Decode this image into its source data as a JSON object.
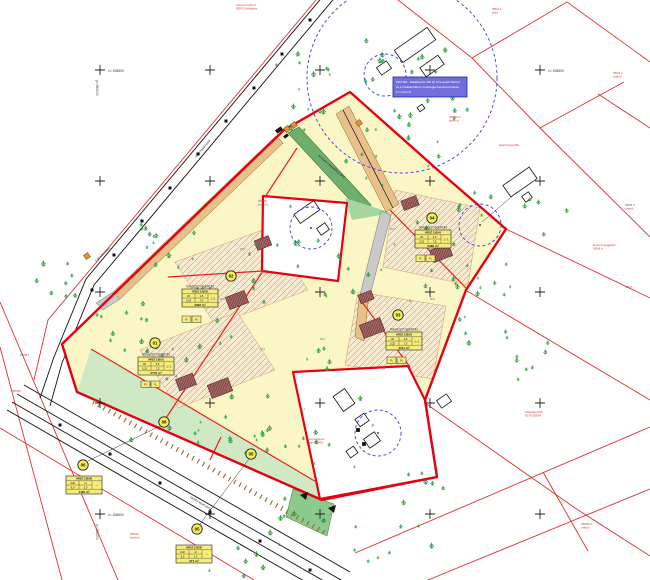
{
  "colors": {
    "parcel_red": "#e03030",
    "boundary_red": "#e60012",
    "site_yellow": "#fbf6c6",
    "zone_bg": "#f8e9cf",
    "zone_hatch": "#d06a35",
    "building_fill": "#8a4a4a",
    "green_strip": "#cfe9c4",
    "green_dark": "#8cc98c",
    "ditch_green": "#6fae6f",
    "drive_tan": "#e7c189",
    "drive_gray": "#c9c9c9",
    "note_blue": "#7070dd",
    "dash_blue": "#3b3be8",
    "tree_green": "#2f9e44",
    "table_yellow": "#f6ec7a"
  },
  "note_box": {
    "lines": [
      "PRV 661 - kialakítandó 160 fm vízvezeték hálózat",
      "és a csatlakozáshoz szükséges bekötővezetékek",
      "5 m² közmű"
    ]
  },
  "coord_labels": [
    {
      "x": 108,
      "y": 72,
      "text": "x= 458850",
      "vx": 96,
      "vy": 80,
      "vtext": "y= 562000"
    },
    {
      "x": 548,
      "y": 72,
      "text": "x= 458850",
      "vx": 0,
      "vy": 0,
      "vtext": ""
    },
    {
      "x": 108,
      "y": 516,
      "text": "x= 458650",
      "vx": 96,
      "vy": 524,
      "vtext": "y= 562000"
    }
  ],
  "grid": {
    "cols": [
      100,
      210,
      320,
      430,
      540
    ],
    "rows": [
      70,
      181,
      292,
      403,
      514
    ]
  },
  "plots": [
    {
      "id": "01",
      "circles": [
        [
          155,
          343
        ]
      ],
      "p": [
        141,
        381
      ],
      "p1": "P₁",
      "p2": "P₂",
      "table": {
        "x": 138,
        "y": 357,
        "title": "TERVEZETT BEÉPÍTÉS",
        "header": "HRSZ 1305/1",
        "r1a": "30",
        "r1b": "4,5",
        "r2a": "0,25",
        "r2b": "7,5",
        "ratio": "1 / 1",
        "area": "2775 m²"
      }
    },
    {
      "id": "02",
      "circles": [
        [
          231,
          276
        ]
      ],
      "p": [
        182,
        316
      ],
      "p1": "P₁",
      "p2": "P₂",
      "table": {
        "x": 182,
        "y": 289,
        "title": "TERVEZETT BEÉPÍTÉS",
        "header": "HRSZ 1305/2",
        "r1a": "30",
        "r1b": "4,5",
        "r2a": "0,25",
        "r2b": "7,5",
        "ratio": "1 / 1",
        "area": "2922 m²"
      }
    },
    {
      "id": "03",
      "circles": [
        [
          398,
          315
        ]
      ],
      "p": [
        387,
        357
      ],
      "p1": "P₁",
      "p2": "P₂",
      "table": {
        "x": 386,
        "y": 332,
        "title": "TERVEZETT BEÉPÍTÉS",
        "header": "HRSZ 1305/3",
        "r1a": "30",
        "r1b": "4,5",
        "r2a": "0,25",
        "r2b": "7,5",
        "ratio": "1 / 1",
        "area": "2011 m²"
      }
    },
    {
      "id": "04",
      "circles": [
        [
          432,
          218
        ]
      ],
      "p": [
        416,
        255
      ],
      "p1": "P₁",
      "p2": "P₂",
      "table": {
        "x": 415,
        "y": 230,
        "title": "TERVEZETT BEÉPÍTÉS",
        "header": "HRSZ 1305/4",
        "r1a": "30",
        "r1b": "4,5",
        "r2a": "0,25",
        "r2b": "7,5",
        "ratio": "1 / 1",
        "area": "2989 m²"
      }
    },
    {
      "id": "05",
      "circles": [
        [
          251,
          454
        ],
        [
          197,
          529
        ]
      ],
      "p": null,
      "p1": "",
      "p2": "",
      "table": {
        "x": 176,
        "y": 545,
        "title": "",
        "header": "HRSZ 1305/5",
        "r1a": "zöld",
        "r1b": "út",
        "r2a": "6,0",
        "r2b": "3,0",
        "ratio": "—",
        "area": "671 m²"
      }
    },
    {
      "id": "06",
      "circles": [
        [
          164,
          422
        ],
        [
          83,
          465
        ]
      ],
      "p": null,
      "p1": "",
      "p2": "",
      "table": {
        "x": 66,
        "y": 476,
        "title": "",
        "header": "HRSZ 1305/6",
        "r1a": "zöld",
        "r1b": "út",
        "r2a": "6,0",
        "r2b": "3,0",
        "ratio": "—",
        "area": "1420 m²"
      }
    }
  ],
  "red_labels": [
    {
      "x": 236,
      "y": 6,
      "lines": [
        "Tervezett 20 kV",
        "055/71 földkábel"
      ]
    },
    {
      "x": 492,
      "y": 10,
      "lines": [
        "055/2 b",
        "erdő"
      ]
    },
    {
      "x": 613,
      "y": 74,
      "lines": [
        "055/4 c",
        "szántó"
      ]
    },
    {
      "x": 449,
      "y": 118,
      "lines": [
        "055/60-2",
        "kivett út"
      ]
    },
    {
      "x": 499,
      "y": 146,
      "lines": [
        "kivett tanya 05a"
      ]
    },
    {
      "x": 625,
      "y": 206,
      "lines": [
        "055/5 b",
        "szántó"
      ]
    },
    {
      "x": 593,
      "y": 246,
      "lines": [
        "kivett anyaggödör",
        "055/6 b"
      ]
    },
    {
      "x": 625,
      "y": 288,
      "lines": [
        "055/7"
      ]
    },
    {
      "x": 258,
      "y": 202,
      "lines": [
        "055/59",
        "kivett út"
      ]
    },
    {
      "x": 525,
      "y": 413,
      "lines": [
        "külterület 05b",
        "6070 055/64"
      ]
    },
    {
      "x": 581,
      "y": 525,
      "lines": [
        "055/65 b",
        "szántó"
      ]
    },
    {
      "x": 306,
      "y": 440,
      "lines": [
        "kivett tanya és",
        "udvar 055/63"
      ]
    },
    {
      "x": 130,
      "y": 535,
      "lines": [
        "055/54",
        "kivett út"
      ]
    },
    {
      "x": 12,
      "y": 392,
      "lines": [
        "055/52"
      ]
    },
    {
      "x": 20,
      "y": 356,
      "lines": [
        "055/51"
      ]
    }
  ],
  "black_labels": [
    {
      "x": 96,
      "y": 262,
      "rot": -44,
      "text": "3 db kőris fasor"
    },
    {
      "x": 318,
      "y": 156,
      "rot": 41,
      "text": "tervezett csapadékvíz árok"
    },
    {
      "x": 196,
      "y": 158,
      "rot": -50,
      "text": "054/2 kivett közút"
    },
    {
      "x": 190,
      "y": 498,
      "rot": 30,
      "text": "055/54 kivett közút"
    }
  ],
  "spot_heights": [
    {
      "x": 220,
      "y": 300,
      "v": "93,6"
    },
    {
      "x": 260,
      "y": 350,
      "v": "93,9"
    },
    {
      "x": 180,
      "y": 390,
      "v": "94,1"
    },
    {
      "x": 320,
      "y": 340,
      "v": "93,4"
    },
    {
      "x": 430,
      "y": 300,
      "v": "92,8"
    },
    {
      "x": 390,
      "y": 230,
      "v": "92,5"
    },
    {
      "x": 240,
      "y": 250,
      "v": "94,0"
    },
    {
      "x": 300,
      "y": 410,
      "v": "93,1"
    }
  ],
  "tree_clusters": [
    [
      295,
      88,
      38,
      45,
      14
    ],
    [
      168,
      240,
      48,
      36,
      12
    ],
    [
      62,
      282,
      30,
      26,
      8
    ],
    [
      390,
      150,
      52,
      40,
      12
    ],
    [
      440,
      118,
      38,
      28,
      8
    ],
    [
      205,
      325,
      85,
      65,
      16
    ],
    [
      300,
      255,
      55,
      55,
      10
    ],
    [
      405,
      255,
      65,
      55,
      12
    ],
    [
      255,
      425,
      75,
      35,
      10
    ],
    [
      350,
      335,
      55,
      45,
      9
    ],
    [
      485,
      300,
      35,
      60,
      14
    ],
    [
      520,
      345,
      30,
      35,
      8
    ],
    [
      470,
      195,
      28,
      28,
      6
    ],
    [
      545,
      215,
      25,
      20,
      5
    ],
    [
      330,
      435,
      55,
      55,
      10
    ],
    [
      415,
      470,
      35,
      35,
      7
    ],
    [
      295,
      525,
      45,
      28,
      8
    ],
    [
      385,
      545,
      55,
      25,
      8
    ],
    [
      200,
      445,
      80,
      22,
      10
    ],
    [
      240,
      562,
      55,
      18,
      6
    ],
    [
      150,
      368,
      40,
      30,
      8
    ],
    [
      120,
      330,
      30,
      25,
      6
    ],
    [
      360,
      60,
      30,
      30,
      6
    ],
    [
      430,
      60,
      35,
      25,
      5
    ]
  ],
  "poles_road1": [
    [
      310,
      20
    ],
    [
      282,
      54
    ],
    [
      254,
      88
    ],
    [
      226,
      121
    ],
    [
      198,
      154
    ],
    [
      170,
      188
    ],
    [
      142,
      221
    ],
    [
      114,
      255
    ],
    [
      92,
      290
    ]
  ],
  "poles_road2": [
    [
      60,
      425
    ],
    [
      110,
      454
    ],
    [
      160,
      483
    ],
    [
      210,
      512
    ],
    [
      260,
      541
    ],
    [
      310,
      570
    ]
  ],
  "embankment": {
    "x1": 95,
    "y1": 400,
    "x2": 325,
    "y2": 530,
    "step": 6,
    "len": 5
  }
}
